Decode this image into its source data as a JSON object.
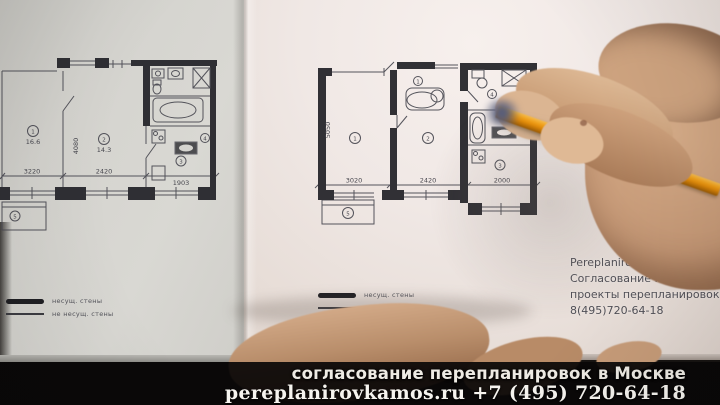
{
  "caption_band": {
    "line1": "согласование перепланировок в Москве",
    "line2": "pereplanirovkamos.ru +7 (495) 720-64-18"
  },
  "watermark": {
    "line1": "Pereplanirovkamos..",
    "line2": "Согласование перепл.",
    "line3": "проекты перепланировок",
    "line4": "8(495)720-64-18"
  },
  "legend": {
    "solid": "несущ. стены",
    "thin": "не несущ. стены"
  },
  "plan_left": {
    "dims": [
      "3220",
      "2420",
      "1903"
    ],
    "side_dim": "4080",
    "room1_num": "1",
    "room1_area": "16.6",
    "room2_num": "2",
    "room2_area": "14.3",
    "room3_num": "3",
    "room4_num": "4",
    "balcony_num": "5"
  },
  "plan_right": {
    "dims": [
      "3020",
      "2420",
      "2000"
    ],
    "side_dim": "5050",
    "room1_num": "1",
    "room2_num": "2",
    "room3_num": "3",
    "wc_num": "4",
    "door_num": "1",
    "balcony_num": "5"
  },
  "colors": {
    "pencil_body": "#e8930d",
    "caption_background": "#0c0a09",
    "caption_text": "#f3f0ea",
    "plan_ink": "#2c2c31",
    "page_left": "#d5d4cf",
    "page_right": "#f0e8e5",
    "skin": "#c79c78"
  }
}
